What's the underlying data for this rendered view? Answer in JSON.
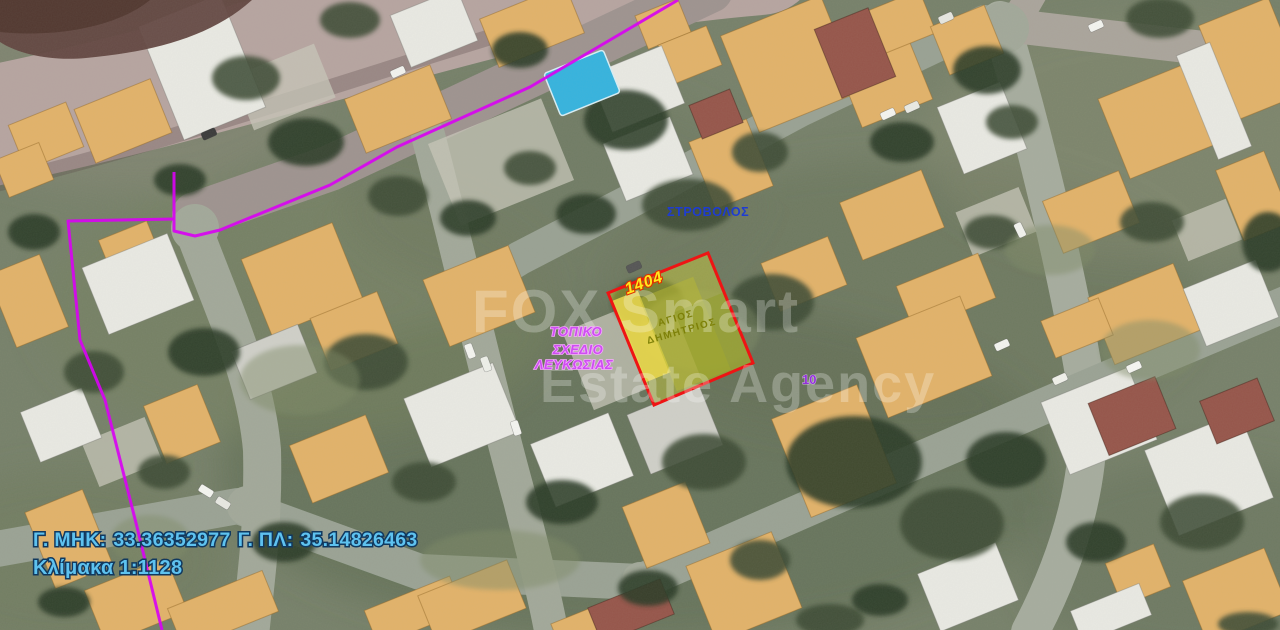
{
  "map": {
    "area_label": "ΣΤΡΟΒΟΛΟΣ",
    "plan_label": {
      "line1": "ΤΟΠΙΚΟ",
      "line2": "ΣΧΕΔΙΟ",
      "line3": "ΛΕΥΚΩΣΙΑΣ"
    },
    "parcel": {
      "number": "1404",
      "name_line1": "ΑΓΙΟΣ",
      "name_line2": "ΔΗΜΗΤΡΙΟΣ"
    },
    "road_number": "10",
    "watermark": {
      "line1": "FOX Smart",
      "line2": "Estate Agency"
    }
  },
  "footer": {
    "longitude_label": "Γ. ΜΗΚ:",
    "longitude_value": "33.36352977",
    "latitude_label": "Γ. ΠΛ:",
    "latitude_value": "35.14826463",
    "scale_text": "Κλίμακα 1:1128"
  },
  "colors": {
    "boundary_magenta": "#d803f2",
    "parcel_outline_red": "#ee1414",
    "parcel_fill_yellow": "#d6d63a",
    "building_orange": "#e2b269",
    "coords_text_blue": "#5ec2ef",
    "area_text_blue": "#1e3cd2",
    "plan_text_magenta": "#cf4ef2",
    "parcel_number_yellow": "#ffe81e",
    "road_number_purple": "#9232d8",
    "pool_blue": "#35b3de"
  }
}
